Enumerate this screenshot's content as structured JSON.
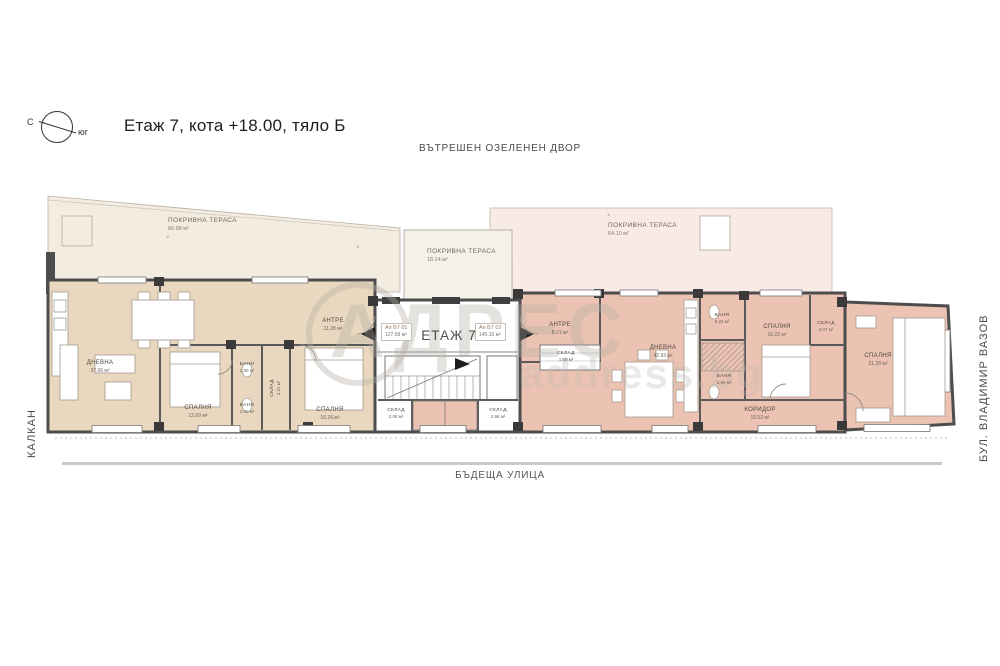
{
  "header": {
    "title": "Етаж 7, кота +18.00, тяло Б",
    "compass_north": "С",
    "compass_south": "юг"
  },
  "context": {
    "top": "ВЪТРЕШЕН ОЗЕЛЕНЕН ДВОР",
    "bottom": "БЪДЕЩА УЛИЦА",
    "left": "КАЛКАН",
    "right": "БУЛ. ВЛАДИМИР ВАЗОВ"
  },
  "core": {
    "floor_label": "ЕТАЖ 7",
    "apartment1_id": "Ап Б7 01",
    "apartment1_area": "127.58 м²",
    "apartment2_id": "Ап Б7 02",
    "apartment2_area": "145.33 м²"
  },
  "terraces": [
    {
      "name": "ПОКРИВНА ТЕРАСА",
      "area": "66.98 м²"
    },
    {
      "name": "ПОКРИВНА ТЕРАСА",
      "area": "18.24 м²"
    },
    {
      "name": "ПОКРИВНА ТЕРАСА",
      "area": "64.10 м²"
    }
  ],
  "apartment1_rooms": [
    {
      "name": "ДНЕВНА",
      "area": "37.06 м²"
    },
    {
      "name": "СПАЛНЯ",
      "area": "12.69 м²"
    },
    {
      "name": "АНТРЕ",
      "area": "11.28 м²"
    },
    {
      "name": "БАНЯ",
      "area": "2.90 м²"
    },
    {
      "name": "СКЛАД",
      "area": "3.31 м²"
    },
    {
      "name": "БАНЯ",
      "area": "3.00 м²"
    },
    {
      "name": "СПАЛНЯ",
      "area": "16.26 м²"
    },
    {
      "name": "СКЛАД",
      "area": "2.06 м²"
    }
  ],
  "apartment2_rooms": [
    {
      "name": "СКЛАД",
      "area": "2.98 м²"
    },
    {
      "name": "АНТРЕ",
      "area": "8.21 м²"
    },
    {
      "name": "СКЛАД",
      "area": "1.59 м²"
    },
    {
      "name": "ДНЕВНА",
      "area": "42.93 м²"
    },
    {
      "name": "БАНЯ",
      "area": "5.22 м²"
    },
    {
      "name": "СПАЛНЯ",
      "area": "16.22 м²"
    },
    {
      "name": "СКЛАД",
      "area": "3.07 м²"
    },
    {
      "name": "БАНЯ",
      "area": "3.99 м²"
    },
    {
      "name": "КОРИДОР",
      "area": "10.52 м²"
    },
    {
      "name": "СПАЛНЯ",
      "area": "21.28 м²"
    }
  ],
  "watermark": {
    "text": "АДРЕС",
    "subtext": "address.bg"
  },
  "marker": "×",
  "colors": {
    "apartment1_fill": "#e9d8bf",
    "apartment2_fill": "#ecc3b2",
    "terrace_left_fill": "#f3ece1",
    "terrace_right_fill": "#f8ebe5",
    "wall": "#4d4d4d",
    "street": "#cbcbcb"
  }
}
